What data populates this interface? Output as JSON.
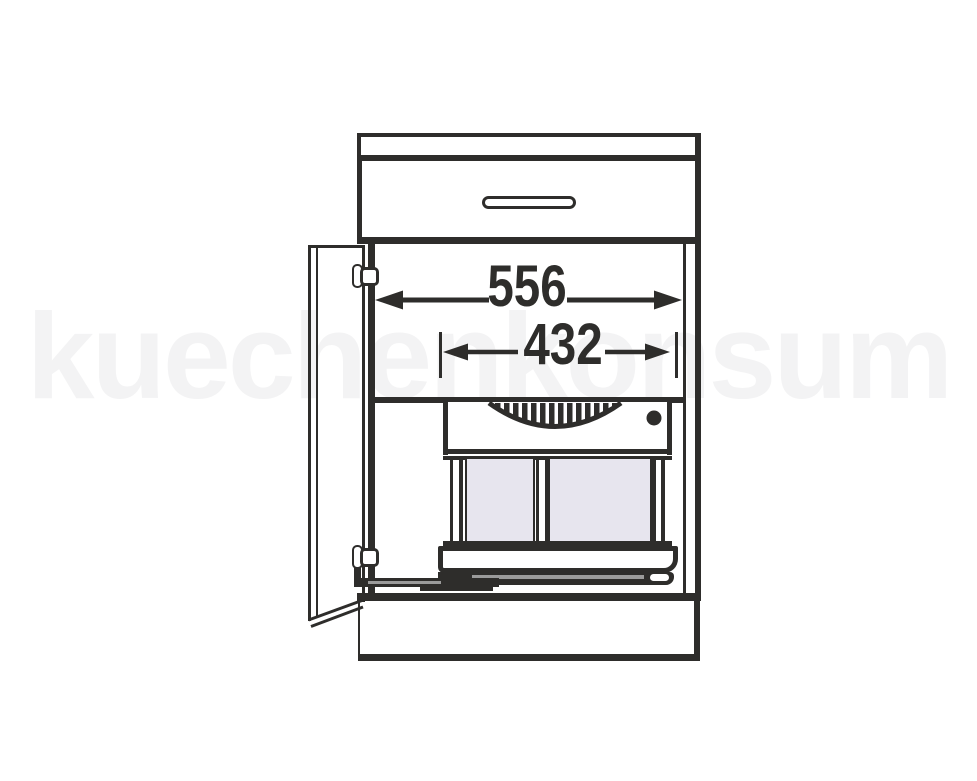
{
  "watermark": {
    "text": "kuechenkonsum"
  },
  "dimensions": {
    "overall_inner_width": "556",
    "pullout_unit_width": "432"
  },
  "colors": {
    "line": "#2e2d2b",
    "bin_fill": "#e7e5ee",
    "rail_highlight": "#9b9b9b",
    "watermark": "#f3f3f4",
    "background": "#ffffff"
  }
}
